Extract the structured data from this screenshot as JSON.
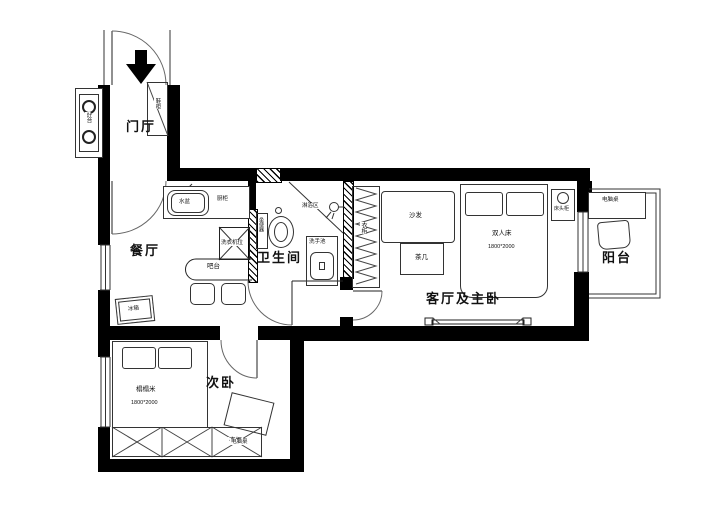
{
  "rooms": {
    "entry": "门厅",
    "dining": "餐厅",
    "bathroom": "卫生间",
    "living_master": "客厅及主卧",
    "balcony": "阳台",
    "second_bedroom": "次卧"
  },
  "kitchen": {
    "stove": "灶台",
    "sink": "水盆",
    "cabinet": "厨柜",
    "washing_machine": "洗衣机位",
    "bar": "吧台",
    "fridge": "冰箱"
  },
  "entry_items": {
    "shoe_cabinet": "鞋柜"
  },
  "bathroom_items": {
    "shower_area": "淋浴区",
    "toilet": "坐便器",
    "basin": "洗手池"
  },
  "living_items": {
    "wardrobe": "衣柜",
    "sofa": "沙发",
    "tea_table": "茶几",
    "bed": "双人床",
    "bed_size": "1800*2000",
    "bedside_table": "床头柜"
  },
  "balcony_items": {
    "desk": "电脑桌"
  },
  "bedroom_items": {
    "bed": "榻榻米",
    "bed_size": "1800*2000",
    "wardrobe": "衣柜",
    "desk": "电脑桌"
  },
  "colors": {
    "wall": "#000000",
    "background": "#ffffff",
    "line": "#444444"
  }
}
